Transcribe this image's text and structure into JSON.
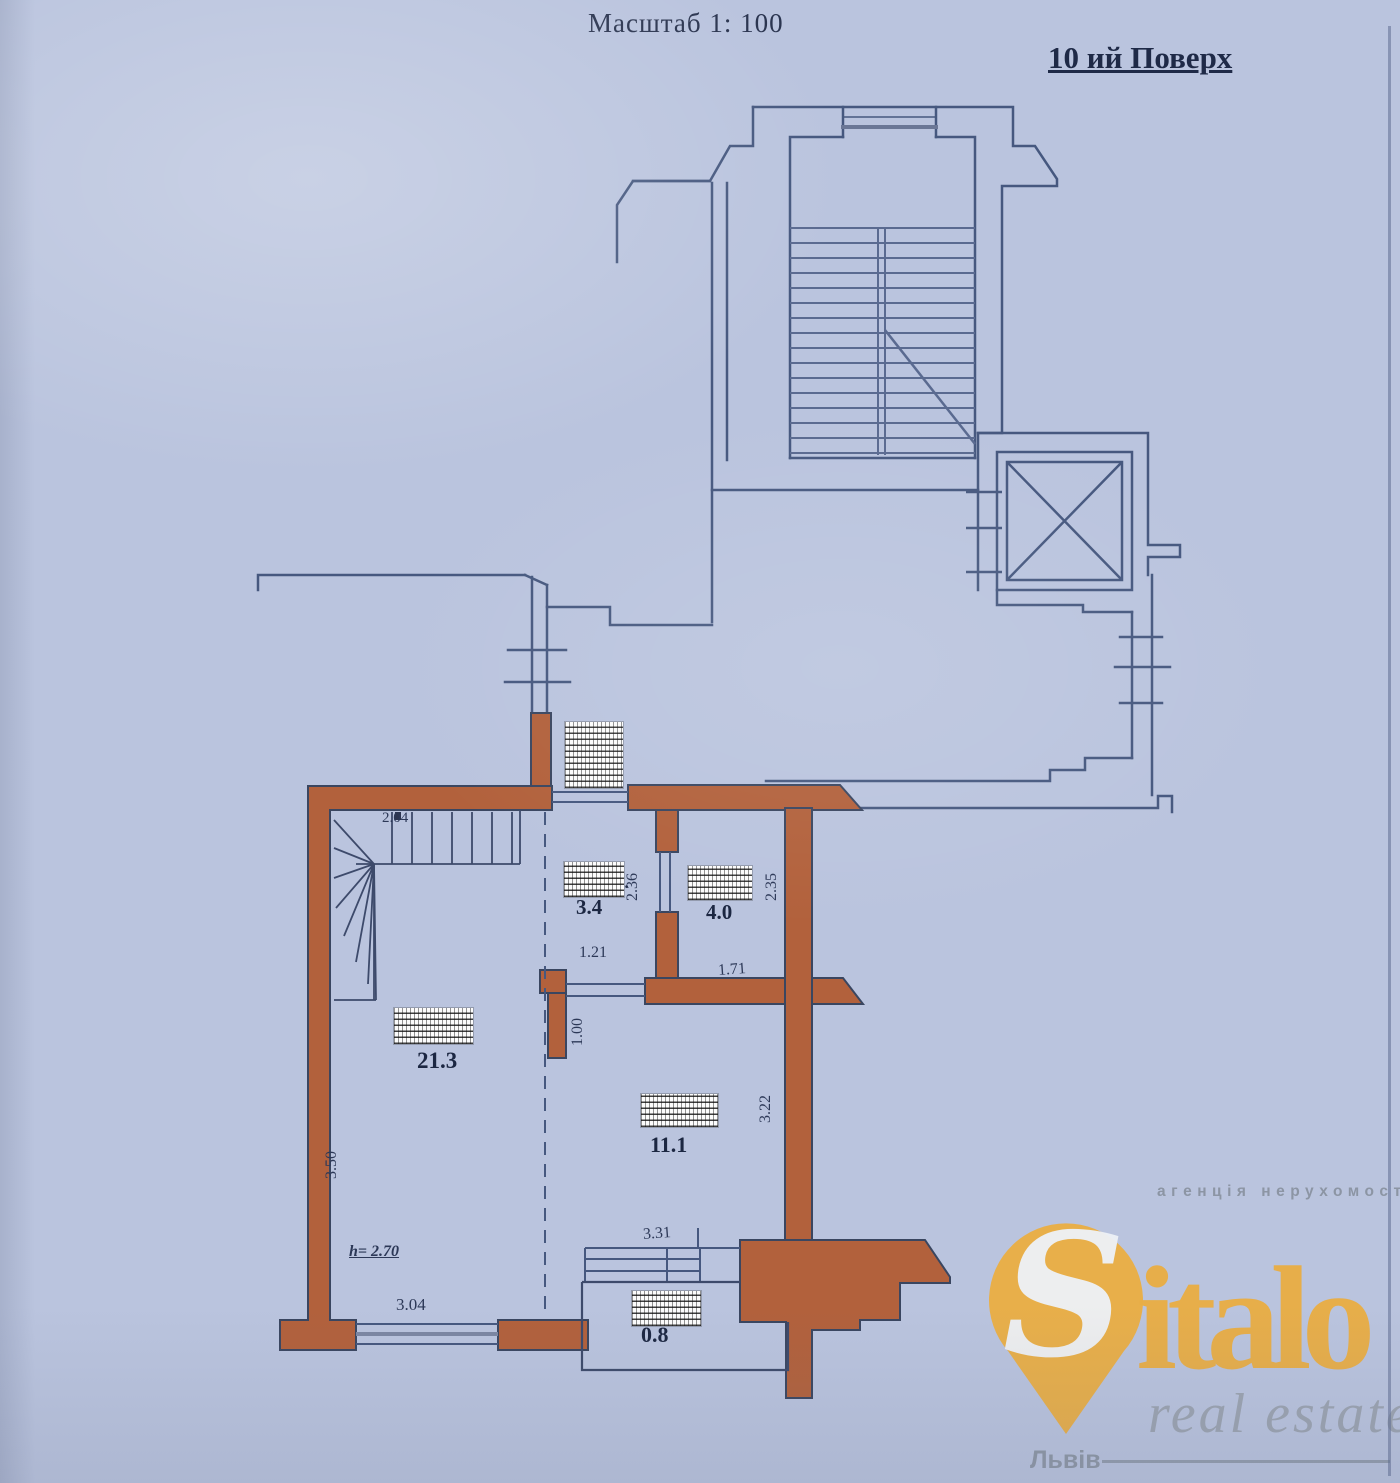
{
  "page": {
    "scale_label": "Масштаб 1: 100",
    "floor_label": "10 ий Поверх"
  },
  "plan": {
    "rooms": {
      "hall_area": "3.4",
      "wc_area": "4.0",
      "living_area": "21.3",
      "room_area": "11.1",
      "balcony_area": "0.8"
    },
    "dims": {
      "stair_width": "2.04",
      "hall_width": "1.21",
      "wc_width": "1.71",
      "hall_height": "2.36",
      "wc_height": "2.35",
      "stub_height": "1.00",
      "room_height": "3.22",
      "living_height": "3.50",
      "living_width": "3.04",
      "balcony_width": "3.31"
    },
    "height_note": "h= 2.70",
    "censored_fragment": "1.",
    "colors": {
      "wall_brown": "#b2613c",
      "line_blue": "#46587f"
    }
  },
  "watermark": {
    "tagline": "агенція нерухомості",
    "brand_s": "S",
    "brand_rest": "italo",
    "subtitle": "real estate",
    "city": "Львів",
    "gold": "#e9ae45",
    "gray": "#8b939f"
  }
}
